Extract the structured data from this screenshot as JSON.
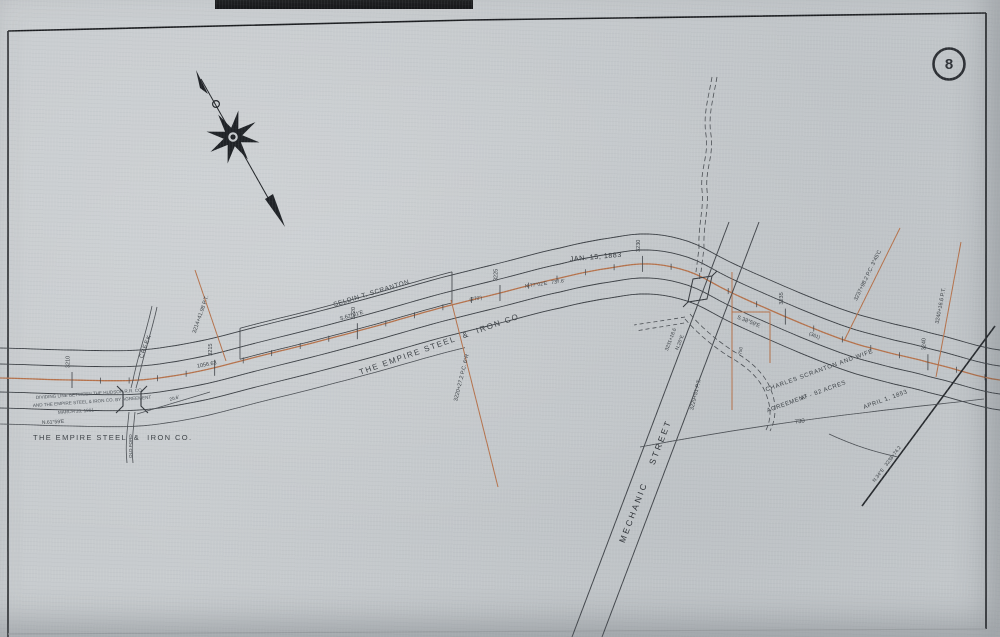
{
  "sheet": {
    "number": "8",
    "paper_color": "#c7cbce",
    "ink_color": "#3a3e43",
    "accent_color": "#b5714a"
  },
  "icons": {
    "compass": "compass-rose-north-arrow",
    "badge": "sheet-number-circle"
  },
  "stations": {
    "labels": [
      "3210",
      "3215",
      "3220",
      "3225",
      "3230",
      "3235",
      "3240"
    ]
  },
  "labels": {
    "date_1883": "JAN. 15, 1883",
    "seldin_scranton": "SELDIN T. SCRANTON",
    "seldin_bearing": "S.62°01'E",
    "empire_diagonal": "THE EMPIRE STEEL  &  IRON CO.",
    "empire_bottom": "THE EMPIRE STEEL  &  IRON CO.",
    "note_line1": "DIVIDING LINE BETWEEN THE HUDSON R.R. CO.",
    "note_line2": "AND THE EMPIRE STEEL & IRON CO. BY AGREEMENT",
    "note_line3": "MARCH 20, 1901",
    "bearing_left": "N.61°59'E",
    "creek": "CREEK",
    "creek_lower": "OLD FORD",
    "dist_1056": "1056.63",
    "pt_3214": "3214+41.98 P.T.",
    "pc_3220": "3220+27.2  P.C. 6°R",
    "track_bearing_mid": "N.77°02'E   737.6'",
    "dim_270": "(270')",
    "dim_206": "20.6'",
    "station_3231": "3231+18.6",
    "bearing_n26": "N.26°E",
    "pt_3229": "3229+51 P.T.",
    "bearing_s3859": "S.38°59'E",
    "dim_361": "(361)",
    "dim_750": "750",
    "mechanic_street": "MECHANIC    STREET",
    "charles_line1": "CHARLES SCRANTON AND WIFE",
    "charles_line2": "A¹ - 82 ACRES",
    "charles_line3": "AGREEMENT",
    "charles_date": "APRIL 1, 1853",
    "dist_730": "730",
    "pc_3237": "3237+98.2 P.C. 3°45'C",
    "pt_3240": "3240+16.6 P.T.",
    "line_n34e": "N.34°E   3238+74.2"
  }
}
